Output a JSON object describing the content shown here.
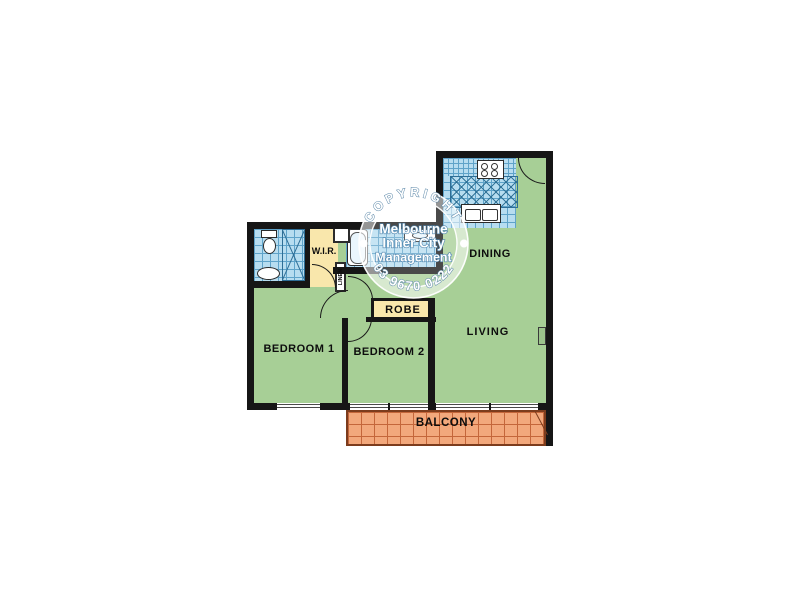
{
  "plan": {
    "rooms": {
      "bedroom1": {
        "label": "BEDROOM 1"
      },
      "bedroom2": {
        "label": "BEDROOM 2"
      },
      "living": {
        "label": "LIVING"
      },
      "dining": {
        "label": "DINING"
      },
      "wir": {
        "label": "W.I.R."
      },
      "robe": {
        "label": "ROBE"
      },
      "linen": {
        "label": "LINEN"
      },
      "balcony": {
        "label": "BALCONY"
      }
    },
    "colors": {
      "floor_green": "#a7cf96",
      "tile_blue": "#b7ddf0",
      "tile_line_blue": "#5fa3c9",
      "robe_yellow": "#f9e7ac",
      "balcony_orange": "#f2a87c",
      "balcony_grid": "#c4663a",
      "wall_black": "#161616"
    }
  },
  "watermark": {
    "arc_top": "COPYRIGHT",
    "line1": "Melbourne",
    "line2": "Inner City",
    "line3": "Management",
    "arc_bottom": "03 9670 0222"
  }
}
